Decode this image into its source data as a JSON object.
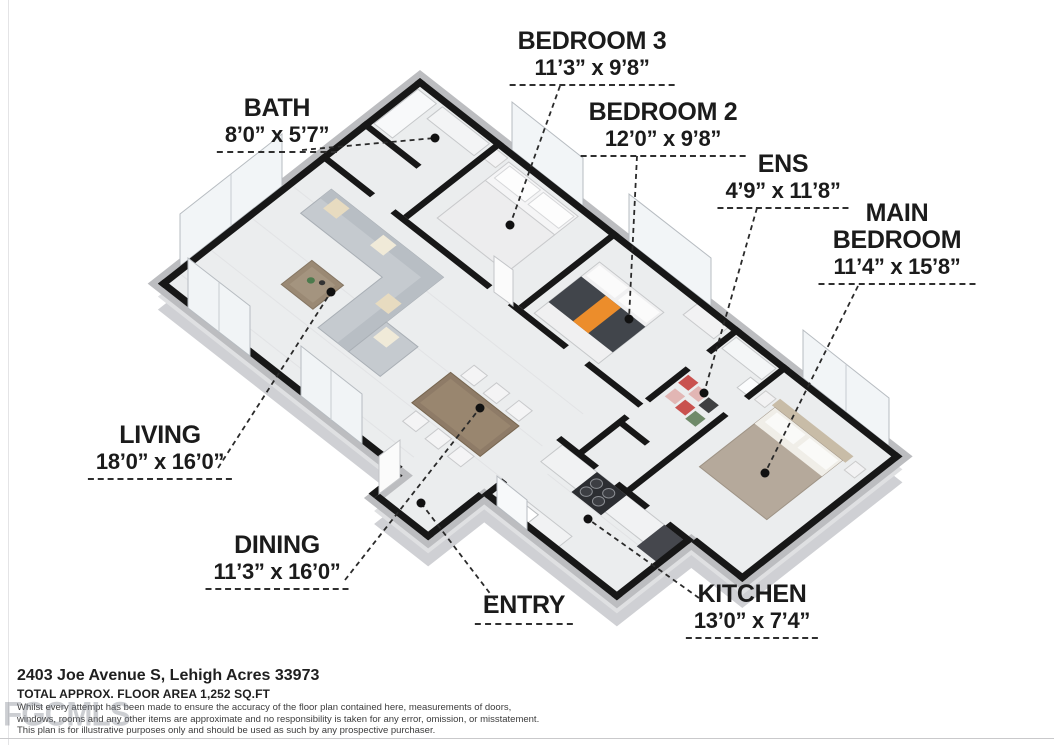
{
  "watermark": "FGCMLS",
  "rooms": [
    {
      "id": "bedroom3",
      "name": "BEDROOM 3",
      "dims": "11’3” x 9’8”"
    },
    {
      "id": "bath",
      "name": "BATH",
      "dims": "8’0” x 5’7”"
    },
    {
      "id": "bedroom2",
      "name": "BEDROOM 2",
      "dims": "12’0” x 9’8”"
    },
    {
      "id": "ens",
      "name": "ENS",
      "dims": "4’9” x 11’8”"
    },
    {
      "id": "main-bedroom",
      "name": "MAIN BEDROOM",
      "dims": "11’4” x 15’8”"
    },
    {
      "id": "living",
      "name": "LIVING",
      "dims": "18’0” x 16’0”"
    },
    {
      "id": "dining",
      "name": "DINING",
      "dims": "11’3” x 16’0”"
    },
    {
      "id": "entry",
      "name": "ENTRY",
      "dims": ""
    },
    {
      "id": "kitchen",
      "name": "KITCHEN",
      "dims": "13’0” x 7’4”"
    }
  ],
  "footer": {
    "address": "2403 Joe Avenue S, Lehigh Acres 33973",
    "area": "TOTAL APPROX. FLOOR AREA 1,252 SQ.FT",
    "disclaimer1": "Whilst every attempt has been made to ensure the accuracy of the floor plan contained here, measurements of doors,",
    "disclaimer2": "windows, rooms and any other items are approximate and no responsibility is taken for any error, omission, or misstatement.",
    "disclaimer3": "This plan is for illustrative purposes only and should be used as such by any prospective purchaser."
  },
  "colors": {
    "wall": "#171717",
    "floor": "#ebedee",
    "accent_orange": "#ec8d2b",
    "bed_taupe": "#b5a99b",
    "sofa_gray": "#c5cacf"
  }
}
